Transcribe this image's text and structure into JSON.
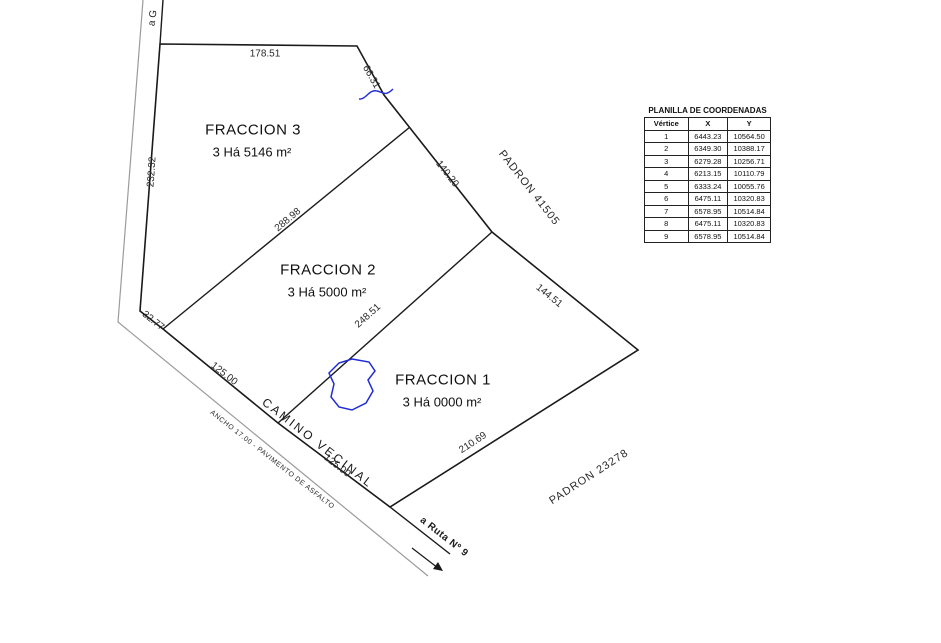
{
  "fractions": [
    {
      "name": "FRACCION 3",
      "area": "3 Há 5146 m²"
    },
    {
      "name": "FRACCION 2",
      "area": "3 Há 5000 m²"
    },
    {
      "name": "FRACCION 1",
      "area": "3 Há 0000 m²"
    }
  ],
  "dimensions": {
    "top": "178.51",
    "left": "232.32",
    "upper_right_1": "66.31",
    "upper_right_2": "140.20",
    "divider_f3_f2": "288.98",
    "divider_f2_f1": "248.51",
    "right": "144.51",
    "road_bend": "32.77",
    "road_frontage_f2": "125.00",
    "road_frontage_f1": "125.00",
    "bottom_right": "210.69"
  },
  "roads": {
    "camino_vecinal": "CAMINO VECINAL",
    "ancho": "ANCHO 17.00 - PAVIMENTO DE ASFALTO",
    "a_ruta": "a Ruta Nº 9",
    "a_destination": "a G"
  },
  "padrones": {
    "east": "PADRON 41505",
    "south": "PADRON 23278"
  },
  "coordinates_table": {
    "title": "PLANILLA DE COORDENADAS",
    "columns": [
      "Vértice",
      "X",
      "Y"
    ],
    "rows": [
      {
        "vertice": "1",
        "x": "6443.23",
        "y": "10564.50"
      },
      {
        "vertice": "2",
        "x": "6349.30",
        "y": "10388.17"
      },
      {
        "vertice": "3",
        "x": "6279.28",
        "y": "10256.71"
      },
      {
        "vertice": "4",
        "x": "6213.15",
        "y": "10110.79"
      },
      {
        "vertice": "5",
        "x": "6333.24",
        "y": "10055.76"
      },
      {
        "vertice": "6",
        "x": "6475.11",
        "y": "10320.83"
      },
      {
        "vertice": "7",
        "x": "6578.95",
        "y": "10514.84"
      },
      {
        "vertice": "8",
        "x": "6475.11",
        "y": "10320.83"
      },
      {
        "vertice": "9",
        "x": "6578.95",
        "y": "10514.84"
      }
    ]
  },
  "colors": {
    "boundary": "#1a1a1a",
    "road_edge": "#9b9b9b",
    "water": "#1f2bd6",
    "text": "#222222"
  }
}
